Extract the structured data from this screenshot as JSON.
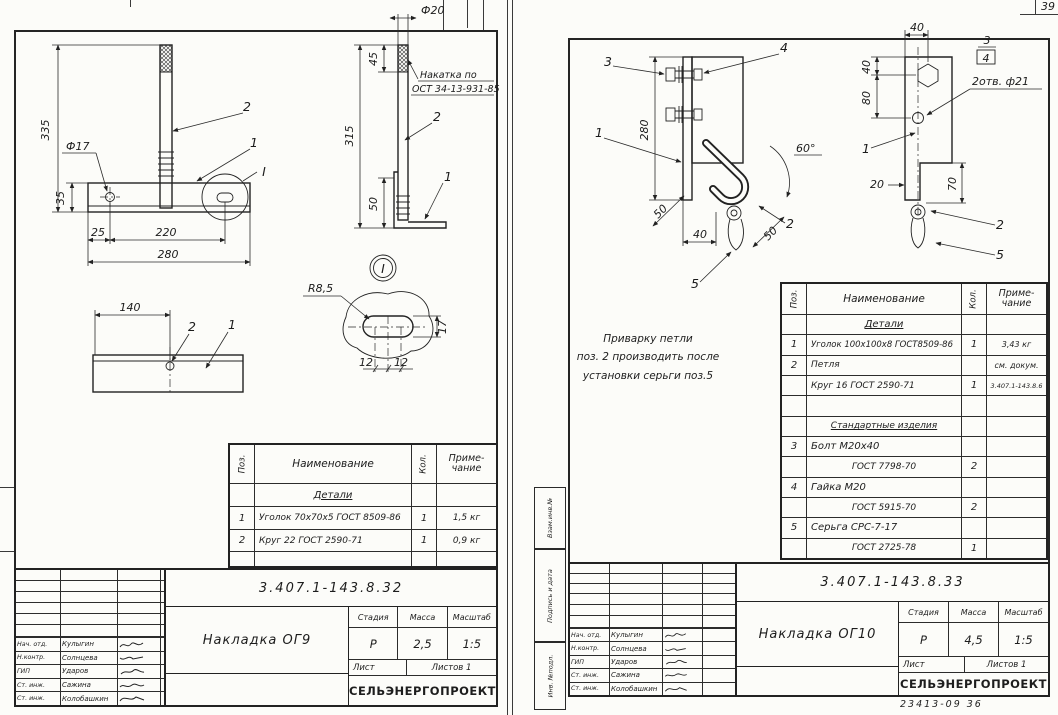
{
  "org": "СЕЛЬЭНЕРГОПРОЕКТ",
  "page": {
    "corner_number": "39",
    "footer_code": "23413-09   36"
  },
  "tb_labels": {
    "stage": "Стадия",
    "mass": "Масса",
    "scale": "Масштаб",
    "sheet": "Лист",
    "sheets": "Листов 1"
  },
  "table_headers": {
    "pos": "Поз.",
    "name": "Наименование",
    "qty": "Кол.",
    "note": "Приме-\nчание"
  },
  "people": [
    {
      "role": "Нач. отд.",
      "name": "Кулыгин"
    },
    {
      "role": "Н.контр.",
      "name": "Солнцева"
    },
    {
      "role": "ГИП",
      "name": "Ударов"
    },
    {
      "role": "Ст. инж.",
      "name": "Сажина"
    },
    {
      "role": "Ст. инж.",
      "name": "Колобашкин"
    }
  ],
  "left_sheet": {
    "title_block": {
      "doc_number": "3.407.1-143.8.32",
      "title": "Накладка ОГ9",
      "stage": "Р",
      "mass": "2,5",
      "scale": "1:5"
    },
    "parts_table": {
      "section": "Детали",
      "rows": [
        {
          "pos": "1",
          "name": "Уголок 70х70х5 ГОСТ 8509-86",
          "qty": "1",
          "note": "1,5 кг"
        },
        {
          "pos": "2",
          "name": "Круг 22 ГОСТ 2590-71",
          "qty": "1",
          "note": "0,9 кг"
        }
      ]
    },
    "drawing": {
      "d335": "335",
      "dia17": "Ф17",
      "d35": "35",
      "d25": "25",
      "d220": "220",
      "d280": "280",
      "p2f": "2",
      "p1f": "1",
      "vi": "I",
      "dia20": "Ф20",
      "d45": "45",
      "d315": "315",
      "d50": "50",
      "k1": "Накатка по",
      "k2": "ОСТ 34-13-931-85",
      "p2s": "2",
      "p1s": "1",
      "di": "I",
      "d140": "140",
      "p2b": "2",
      "p1b": "1",
      "r85": "R8,5",
      "d17": "17",
      "d12a": "12",
      "d12b": "12"
    }
  },
  "right_sheet": {
    "margin_labels": [
      "Взам.инв.№",
      "Подпись и дата",
      "Инв. №подл."
    ],
    "note_lines": [
      "Приварку петли",
      "поз. 2 производить после",
      "установки серьги поз.5"
    ],
    "title_block": {
      "doc_number": "3.407.1-143.8.33",
      "title": "Накладка ОГ10",
      "stage": "Р",
      "mass": "4,5",
      "scale": "1:5"
    },
    "parts_table": {
      "sections": {
        "details": "Детали",
        "standard": "Стандартные изделия"
      },
      "rows": [
        {
          "pos": "1",
          "name": "Уголок 100х100х8 ГОСТ8509-86",
          "qty": "1",
          "note": "3,43 кг"
        },
        {
          "pos": "2",
          "name": "Петля",
          "qty": "",
          "note": "см. докум."
        },
        {
          "pos": "",
          "name": "Круг 16  ГОСТ 2590-71",
          "qty": "1",
          "note": "3.407.1-143.8.6"
        },
        {
          "pos": "3",
          "name": "Болт М20х40",
          "qty": "",
          "note": ""
        },
        {
          "pos": "",
          "name": "ГОСТ 7798-70",
          "qty": "2",
          "note": ""
        },
        {
          "pos": "4",
          "name": "Гайка М20",
          "qty": "",
          "note": ""
        },
        {
          "pos": "",
          "name": "ГОСТ 5915-70",
          "qty": "2",
          "note": ""
        },
        {
          "pos": "5",
          "name": "Серьга СРС-7-17",
          "qty": "",
          "note": ""
        },
        {
          "pos": "",
          "name": "ГОСТ 2725-78",
          "qty": "1",
          "note": ""
        }
      ]
    },
    "drawing": {
      "p3f": "3",
      "p4f": "4",
      "p1f": "1",
      "p2f": "2",
      "p5f": "5",
      "d280": "280",
      "d50a": "50",
      "d40b": "40",
      "d50b": "50",
      "a60": "60°",
      "d40t": "40",
      "d40l": "40",
      "d80": "80",
      "d20": "20",
      "d70": "70",
      "holes": "2отв. ф21",
      "f3": "3",
      "f4": "4",
      "p1s": "1",
      "p2s": "2",
      "p5s": "5"
    }
  }
}
